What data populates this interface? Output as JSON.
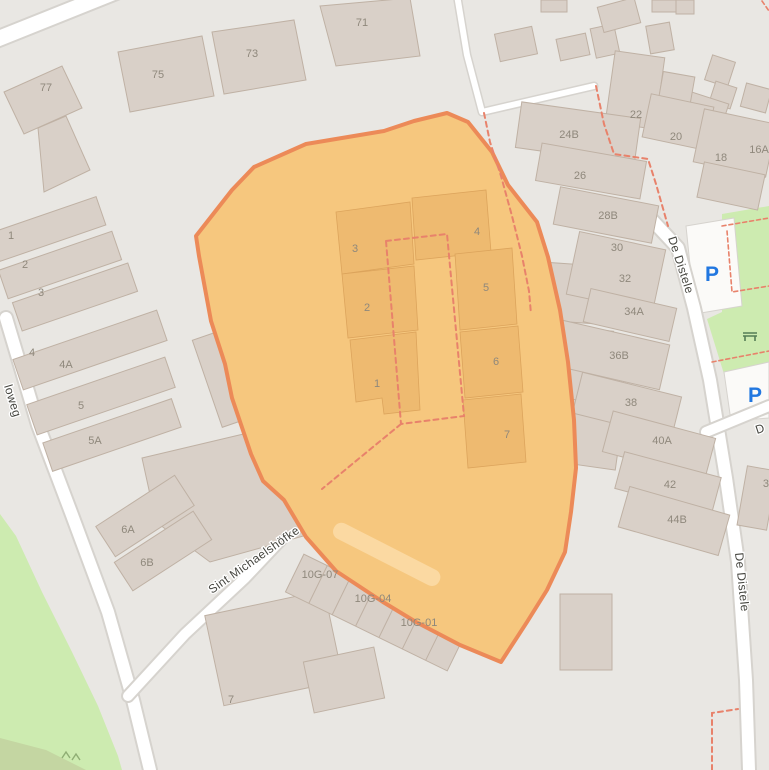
{
  "map": {
    "background_color": "#e9e7e3",
    "building_color": "#d9d0c8",
    "highlight": {
      "fill": "#f6c77e",
      "stroke": "#ec8a58"
    },
    "green_color": "#cdebb0",
    "footpath_dash_color": "#e8826b",
    "parking_blue": "#2277e0"
  },
  "streets": {
    "sint_michaelshofke": "Sint Michaelshöfke",
    "de_distele_upper": "De Distele",
    "de_distele_lower": "De Distele",
    "left_street_partial": "loweg",
    "right_street_partial": "D"
  },
  "parking": {
    "p1": "P",
    "p2": "P"
  },
  "house_numbers": {
    "top": {
      "n71": "71",
      "n73": "73",
      "n75": "75",
      "n77": "77"
    },
    "left": {
      "n1": "1",
      "n2": "2",
      "n3": "3",
      "n4": "4",
      "n4a": "4A",
      "n5": "5",
      "n5a": "5A",
      "n6a": "6A",
      "n6b": "6B",
      "n7": "7"
    },
    "east_row": {
      "n24b": "24B",
      "n26": "26",
      "n28b": "28B",
      "n30": "30",
      "n32": "32",
      "n34a": "34A",
      "n36b": "36B",
      "n38": "38",
      "n40a": "40A",
      "n42": "42",
      "n44b": "44B",
      "n22": "22",
      "n20": "20",
      "n18": "18",
      "n16a": "16A",
      "n39": "39"
    },
    "garages": {
      "g07": "10G-07",
      "g04": "10G-04",
      "g01": "10G-01"
    },
    "highlight_units": {
      "u1": "1",
      "u2": "2",
      "u3": "3",
      "u4": "4",
      "u5": "5",
      "u6": "6",
      "u7": "7"
    }
  }
}
